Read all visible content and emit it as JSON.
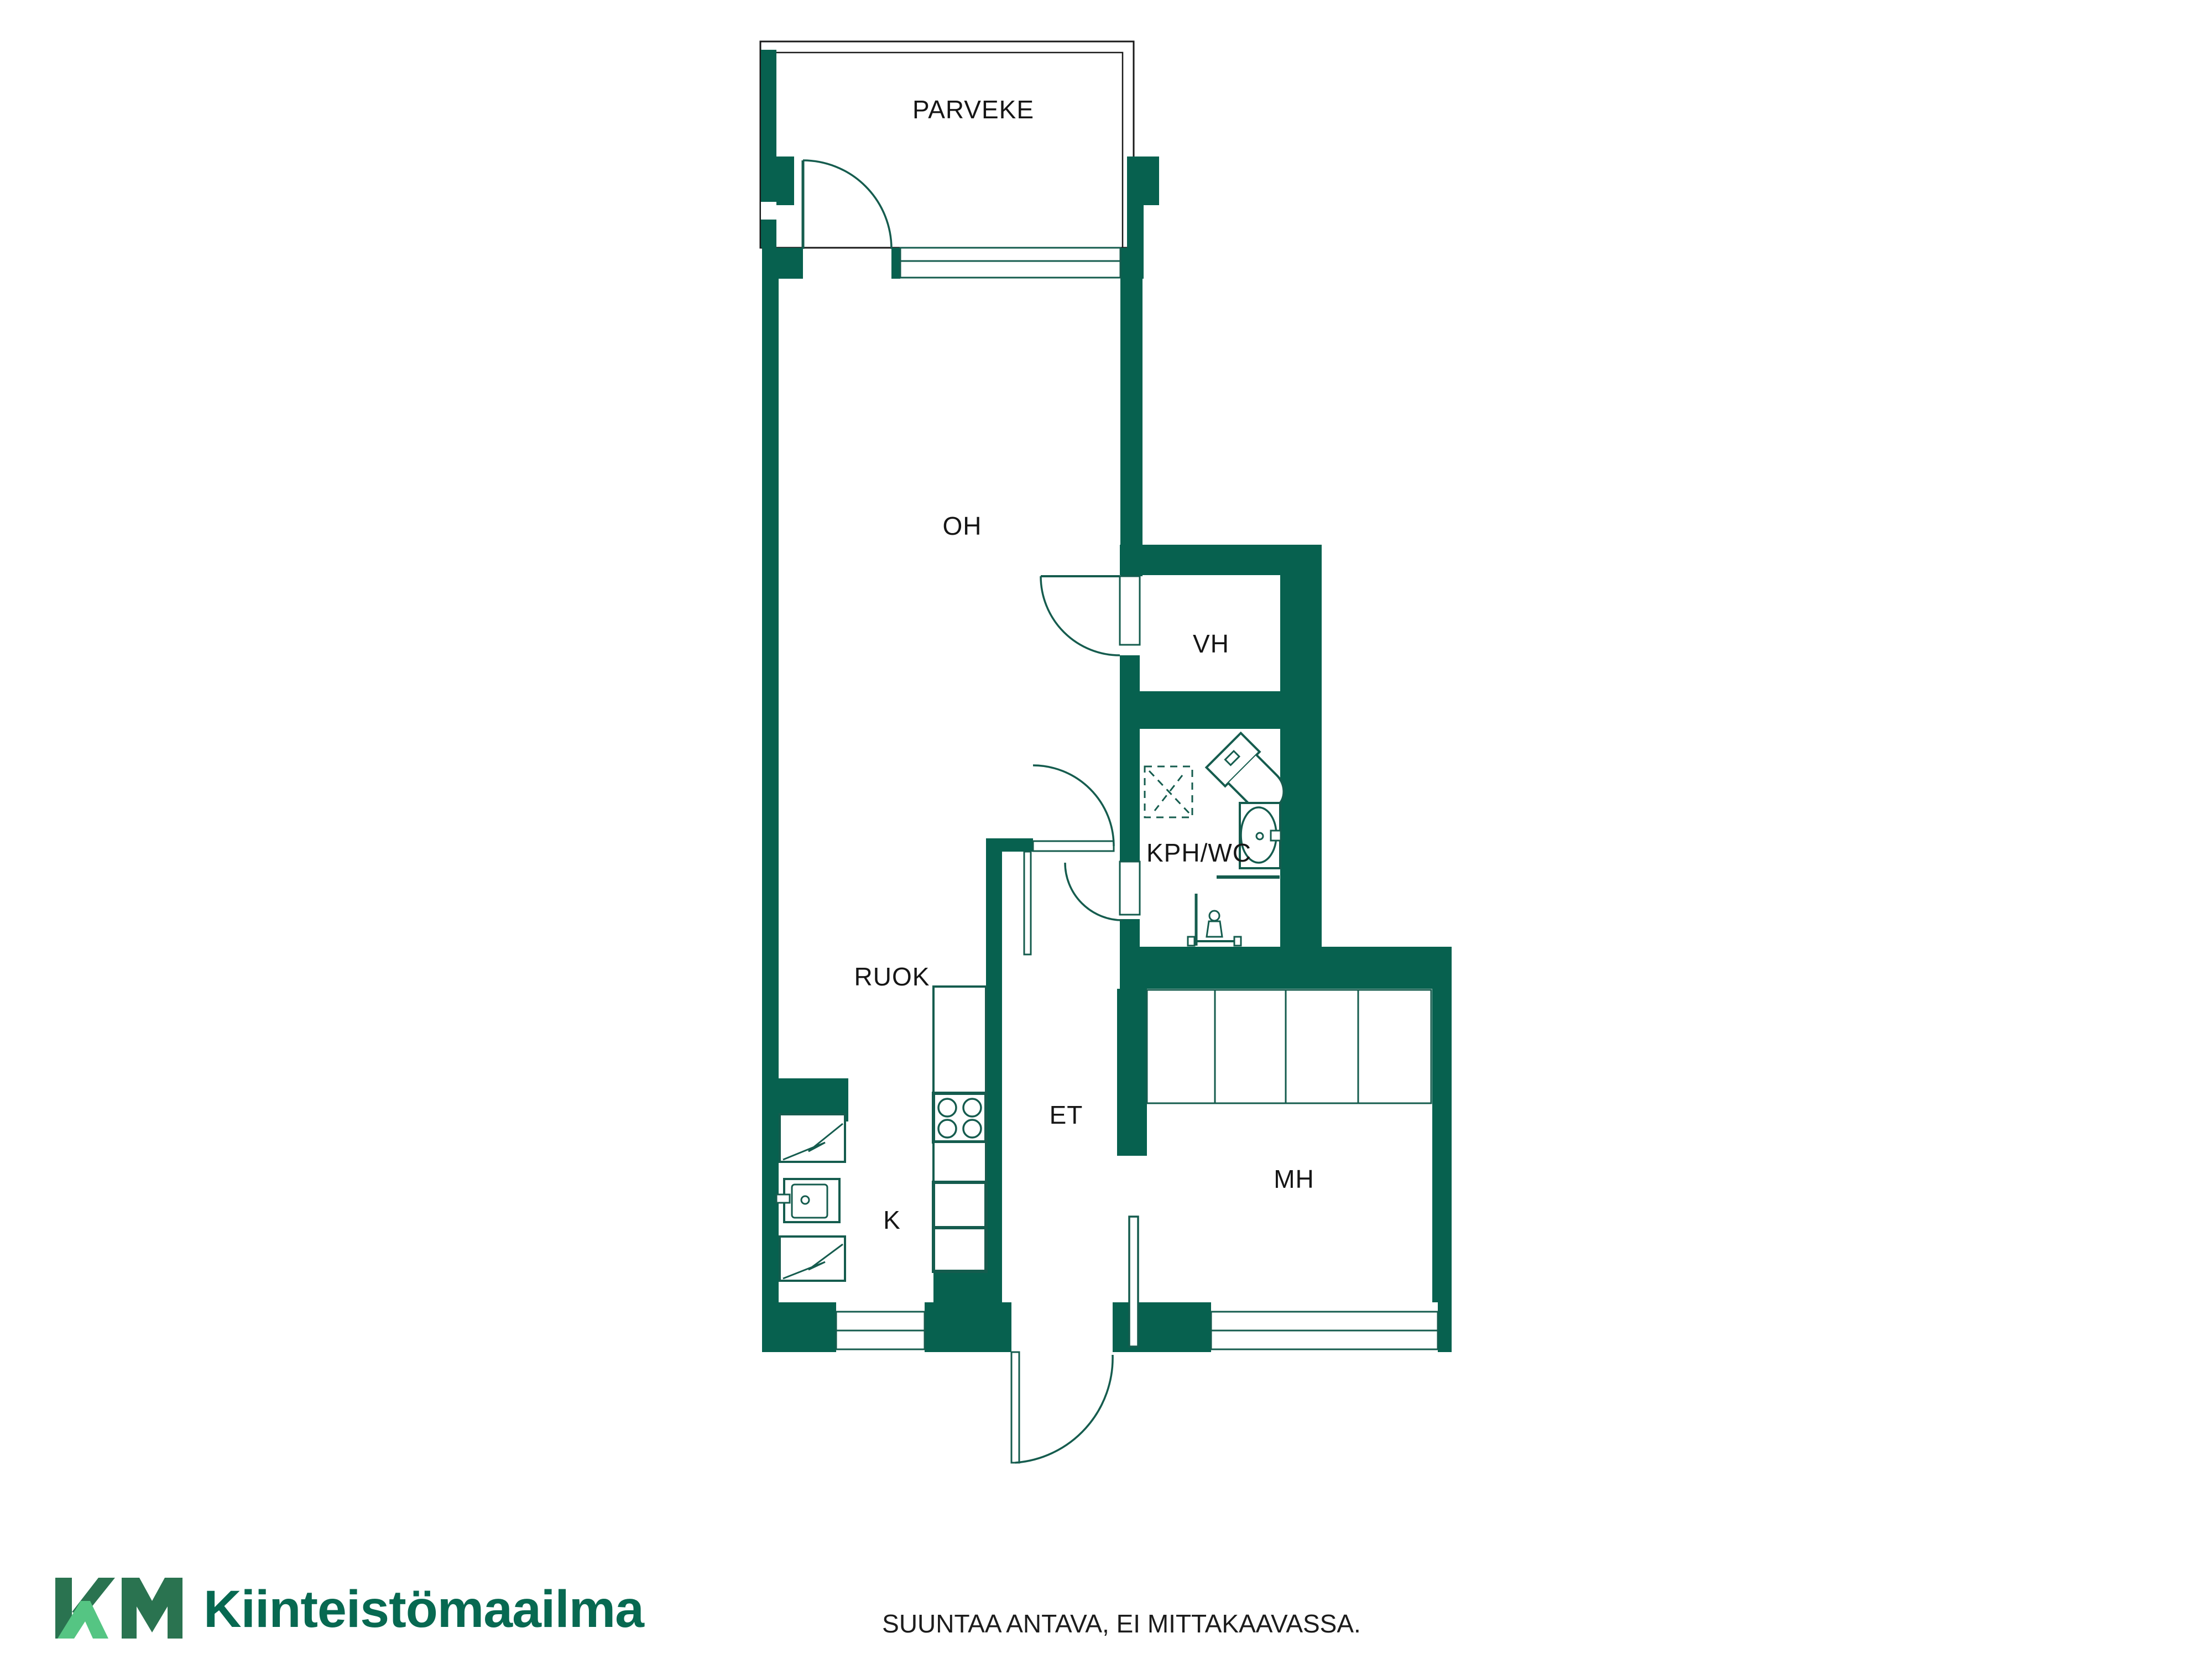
{
  "floorplan": {
    "wall_color": "#07614f",
    "line_color": "#155c4e",
    "label_color": "#161616",
    "outline_color": "#1a1a1a",
    "rooms": [
      {
        "id": "parveke",
        "label": "PARVEKE"
      },
      {
        "id": "oh",
        "label": "OH"
      },
      {
        "id": "vh",
        "label": "VH"
      },
      {
        "id": "kph-wc",
        "label": "KPH/WC"
      },
      {
        "id": "ruok",
        "label": "RUOK"
      },
      {
        "id": "et",
        "label": "ET"
      },
      {
        "id": "k",
        "label": "K"
      },
      {
        "id": "mh",
        "label": "MH"
      }
    ]
  },
  "footer": {
    "brand_mark": "KM",
    "brand_name": "Kiinteistömaailma",
    "brand_dark_green": "#2a7350",
    "brand_light_green": "#55c583",
    "brand_text_color": "#076951",
    "disclaimer": "SUUNTAA ANTAVA, EI MITTAKAAVASSA."
  }
}
